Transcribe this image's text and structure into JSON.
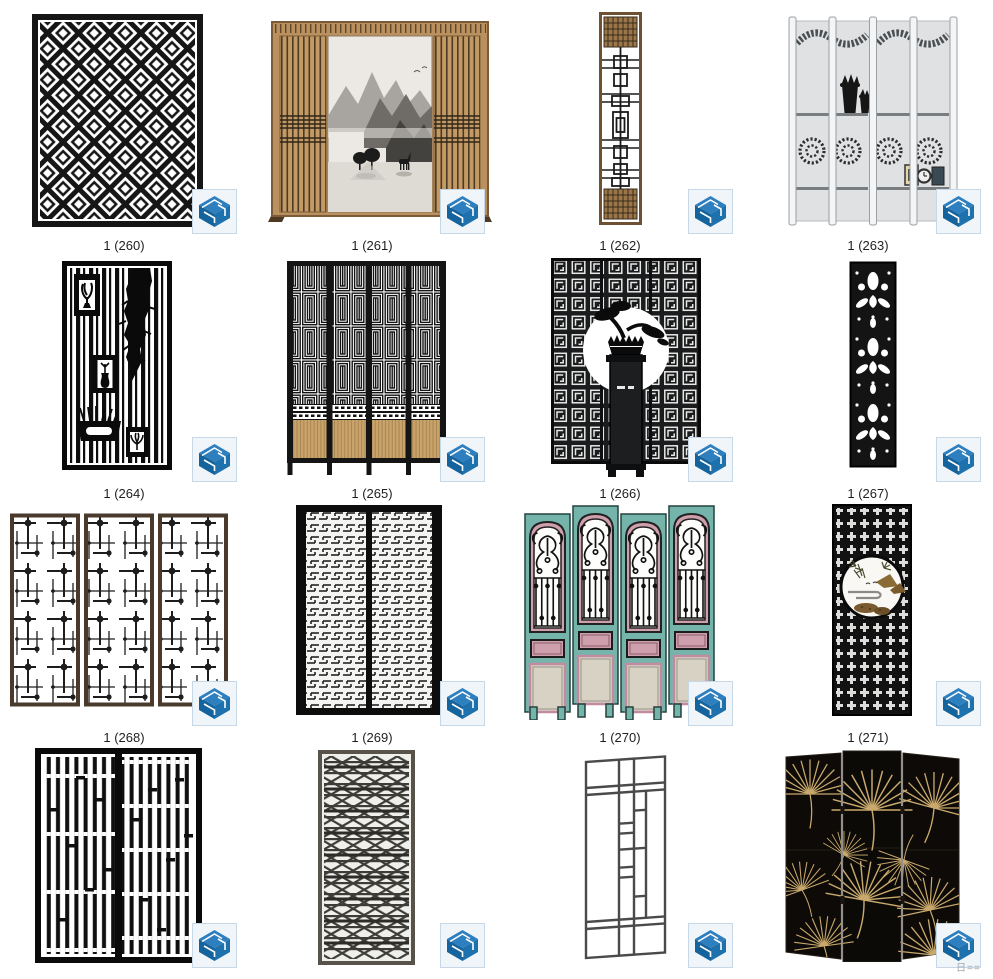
{
  "window": {
    "background": "#ffffff"
  },
  "files": [
    {
      "label": "1 (260)"
    },
    {
      "label": "1 (261)"
    },
    {
      "label": "1 (262)"
    },
    {
      "label": "1 (263)"
    },
    {
      "label": "1 (264)"
    },
    {
      "label": "1 (265)"
    },
    {
      "label": "1 (266)"
    },
    {
      "label": "1 (267)"
    },
    {
      "label": "1 (268)"
    },
    {
      "label": "1 (269)"
    },
    {
      "label": "1 (270)"
    },
    {
      "label": "1 (271)"
    },
    {
      "label": ""
    },
    {
      "label": ""
    },
    {
      "label": ""
    },
    {
      "label": ""
    }
  ],
  "badge": {
    "icon": "sketchup-logo-icon",
    "bg": "#f0f5fa",
    "border": "#c6d7e8",
    "blue_dark": "#15639c",
    "blue_mid": "#2e7fc0"
  },
  "watermark": "日=="
}
